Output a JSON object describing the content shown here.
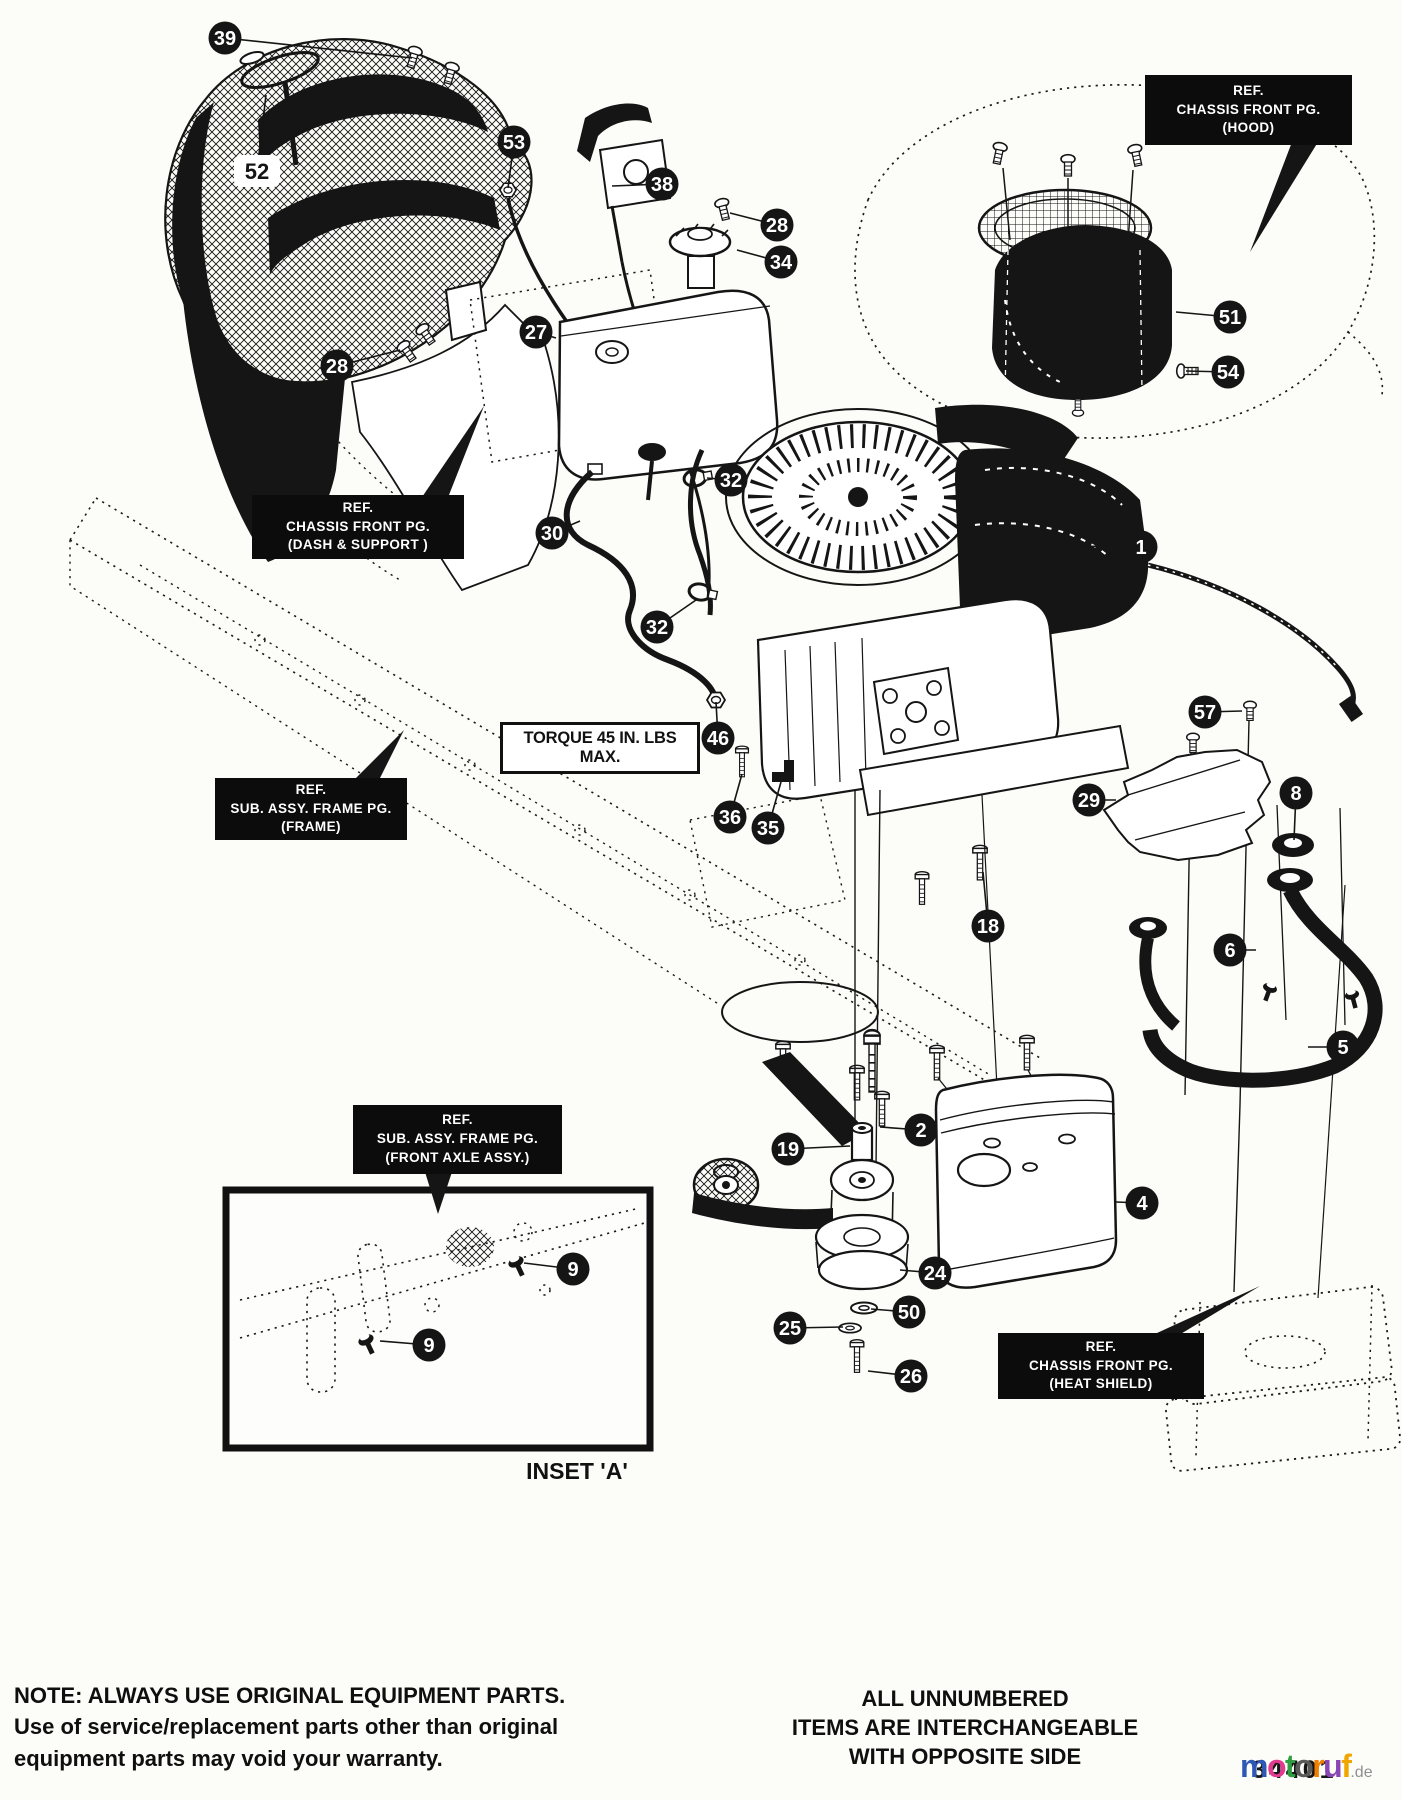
{
  "page": {
    "bg": "#fcfcf8",
    "ink": "#151515"
  },
  "torque_label": "TORQUE 45 IN. LBS MAX.",
  "inset": {
    "label": "INSET 'A'"
  },
  "ref_boxes": [
    {
      "id": "hood",
      "lines": [
        "REF.",
        "CHASSIS FRONT PG.",
        "(HOOD)"
      ]
    },
    {
      "id": "dash-support",
      "lines": [
        "REF.",
        "CHASSIS FRONT PG.",
        "(DASH & SUPPORT )"
      ]
    },
    {
      "id": "frame",
      "lines": [
        "REF.",
        "SUB. ASSY. FRAME PG.",
        "(FRAME)"
      ]
    },
    {
      "id": "front-axle",
      "lines": [
        "REF.",
        "SUB. ASSY. FRAME PG.",
        "(FRONT AXLE ASSY.)"
      ]
    },
    {
      "id": "heat-shield",
      "lines": [
        "REF.",
        "CHASSIS FRONT PG.",
        "(HEAT SHIELD)"
      ]
    }
  ],
  "notes": {
    "left": [
      "NOTE: ALWAYS USE ORIGINAL EQUIPMENT PARTS.",
      "Use of service/replacement parts other than original",
      "equipment parts may void your warranty."
    ],
    "right": [
      "ALL UNNUMBERED",
      "ITEMS ARE INTERCHANGEABLE",
      "WITH OPPOSITE SIDE"
    ]
  },
  "callouts": [
    {
      "label": "39",
      "x": 225,
      "y": 38,
      "tx": 412,
      "ty": 58
    },
    {
      "label": "52",
      "x": 257,
      "y": 171,
      "tx": 266,
      "ty": 95,
      "variant": "light"
    },
    {
      "label": "53",
      "x": 514,
      "y": 142,
      "tx": 508,
      "ty": 188
    },
    {
      "label": "38",
      "x": 662,
      "y": 184,
      "tx": 612,
      "ty": 186
    },
    {
      "label": "28",
      "x": 777,
      "y": 225,
      "tx": 730,
      "ty": 213
    },
    {
      "label": "34",
      "x": 781,
      "y": 262,
      "tx": 737,
      "ty": 250
    },
    {
      "label": "27",
      "x": 536,
      "y": 332,
      "tx": 556,
      "ty": 338
    },
    {
      "label": "28",
      "x": 337,
      "y": 366,
      "tx": 400,
      "ty": 350
    },
    {
      "label": "51",
      "x": 1230,
      "y": 317,
      "tx": 1176,
      "ty": 312
    },
    {
      "label": "54",
      "x": 1228,
      "y": 372,
      "tx": 1186,
      "ty": 371
    },
    {
      "label": "32",
      "x": 731,
      "y": 480,
      "tx": 707,
      "ty": 478
    },
    {
      "label": "30",
      "x": 552,
      "y": 533,
      "tx": 580,
      "ty": 521
    },
    {
      "label": "1",
      "x": 1141,
      "y": 547,
      "tx": 1078,
      "ty": 546
    },
    {
      "label": "32",
      "x": 657,
      "y": 627,
      "tx": 696,
      "ty": 600
    },
    {
      "label": "57",
      "x": 1205,
      "y": 712,
      "tx": 1242,
      "ty": 711
    },
    {
      "label": "46",
      "x": 718,
      "y": 738,
      "tx": 716,
      "ty": 702
    },
    {
      "label": "36",
      "x": 730,
      "y": 817,
      "tx": 742,
      "ty": 774
    },
    {
      "label": "35",
      "x": 768,
      "y": 828,
      "tx": 781,
      "ty": 782
    },
    {
      "label": "29",
      "x": 1089,
      "y": 800,
      "tx": 1116,
      "ty": 800
    },
    {
      "label": "8",
      "x": 1296,
      "y": 793,
      "tx": 1294,
      "ty": 840
    },
    {
      "label": "18",
      "x": 988,
      "y": 926,
      "tx": 983,
      "ty": 872
    },
    {
      "label": "6",
      "x": 1230,
      "y": 950,
      "tx": 1256,
      "ty": 950
    },
    {
      "label": "5",
      "x": 1343,
      "y": 1047,
      "tx": 1308,
      "ty": 1047
    },
    {
      "label": "2",
      "x": 921,
      "y": 1130,
      "tx": 880,
      "ty": 1127
    },
    {
      "label": "19",
      "x": 788,
      "y": 1149,
      "tx": 850,
      "ty": 1146
    },
    {
      "label": "4",
      "x": 1142,
      "y": 1203,
      "tx": 1116,
      "ty": 1202
    },
    {
      "label": "24",
      "x": 935,
      "y": 1273,
      "tx": 900,
      "ty": 1270
    },
    {
      "label": "50",
      "x": 909,
      "y": 1312,
      "tx": 871,
      "ty": 1309
    },
    {
      "label": "25",
      "x": 790,
      "y": 1328,
      "tx": 843,
      "ty": 1327
    },
    {
      "label": "26",
      "x": 911,
      "y": 1376,
      "tx": 868,
      "ty": 1371
    },
    {
      "label": "9",
      "x": 573,
      "y": 1269,
      "tx": 524,
      "ty": 1263
    },
    {
      "label": "9",
      "x": 429,
      "y": 1345,
      "tx": 380,
      "ty": 1341
    }
  ],
  "watermark": {
    "overlay_number": "34401",
    "letters": [
      {
        "ch": "m",
        "color": "#2f58b5"
      },
      {
        "ch": "o",
        "color": "#e23a8e"
      },
      {
        "ch": "t",
        "color": "#2f9e41"
      },
      {
        "ch": "o",
        "color": "#5a5a5a"
      },
      {
        "ch": "r",
        "color": "#f07f00"
      },
      {
        "ch": "u",
        "color": "#8a45b4"
      },
      {
        "ch": "f",
        "color": "#f0a500"
      }
    ],
    "tld": ".de",
    "tld_color": "#8f8f8f"
  }
}
